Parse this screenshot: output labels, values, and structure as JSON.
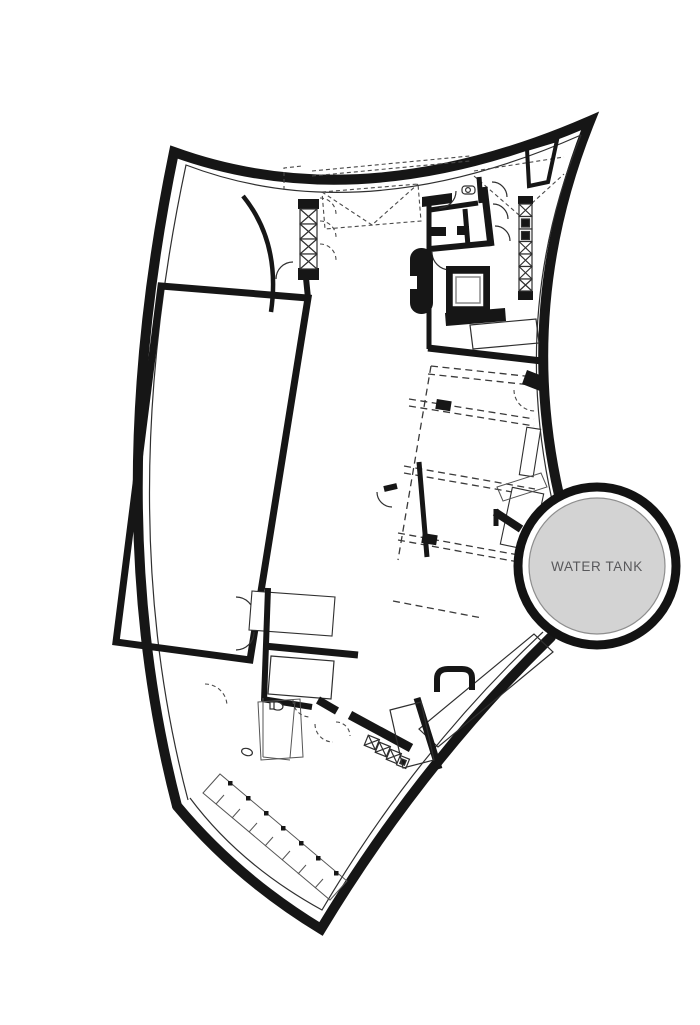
{
  "plan": {
    "water_tank_label": "WATER TANK"
  },
  "colors": {
    "background": "#ffffff",
    "walls": "#161616",
    "tank_fill": "#d3d3d3",
    "tank_edge": "#8e8e8e",
    "tank_ring": "#131313",
    "tank_label": "#58585b",
    "stripe": "#a3a3a3",
    "dashed_line": "#3a3a3a"
  },
  "features": [
    "outer-shell-wall",
    "entrance-canopy-truss",
    "glazed-entrance-shaft",
    "striped-deck-hall",
    "service-rooms-wc",
    "kitchen-equipment-strip",
    "elevator-core",
    "stairs",
    "main-hall-movable-partitions",
    "water-tank",
    "lower-service-rooms",
    "perimeter-terrace-deck"
  ]
}
